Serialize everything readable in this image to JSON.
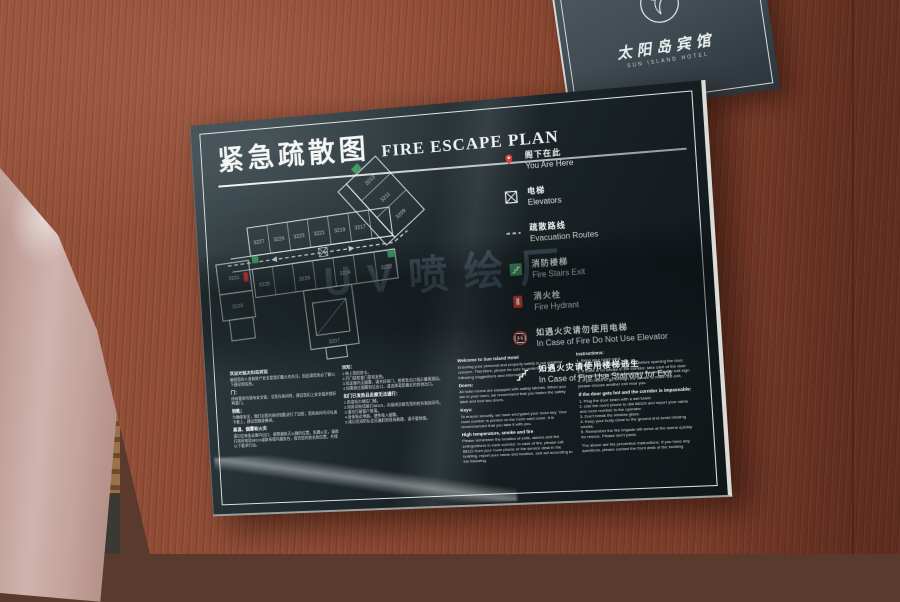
{
  "colors": {
    "accent_red": "#d93a35",
    "exit_green": "#3f9e63",
    "panel": "#1f292c",
    "wood": "#8a4a33",
    "watermark_blue": "#9ec1e4"
  },
  "header_sign": {
    "hotel_name_zh": "太阳岛宾馆",
    "hotel_name_en": "SUN ISLAND HOTEL"
  },
  "sign": {
    "title_zh": "紧急疏散图",
    "title_en": "FIRE ESCAPE PLAN",
    "watermark": "UV喷绘厂",
    "legend": {
      "items": [
        {
          "icon": "you-are-here-marker",
          "zh": "阁下在此",
          "en": "You Are Here"
        },
        {
          "icon": "elevator",
          "zh": "电梯",
          "en": "Elevators"
        },
        {
          "icon": "evacuation-route",
          "zh": "疏散路线",
          "en": "Evacuation Routes"
        },
        {
          "icon": "fire-stairs",
          "zh": "消防楼梯",
          "en": "Fire Stairs Exit"
        },
        {
          "icon": "fire-hydrant",
          "zh": "消火栓",
          "en": "Fire Hydrant"
        },
        {
          "icon": "no-elevator",
          "zh": "如遇火灾请勿使用电梯",
          "en": "In Case of Fire Do Not Use Elevator"
        },
        {
          "icon": "stairway-exit",
          "zh": "如遇火灾请使用楼梯逃生",
          "en": "In Case of Fire Use Stairway for Exit"
        }
      ]
    },
    "plan": {
      "rooms": [
        "3231",
        "3229",
        "3227",
        "3225",
        "3223",
        "3221",
        "3219",
        "3217",
        "3228",
        "3226",
        "3224",
        "3222",
        "3207",
        "3213",
        "3211",
        "3209"
      ]
    },
    "info": {
      "col1": [
        {
          "h": "欢迎光临太阳岛宾馆",
          "p": "确保您的人身和财产安全是我们最大的关注，因此请您务必了解以下建议和信息。"
        },
        {
          "h": "门：",
          "p": "所有客房均装有安全锁，当您在房间时，建议您扣上安全锁并锁好两道门。"
        },
        {
          "h": "钥匙：",
          "p": "为确保安全，我们对您的房间钥匙进行了加密，您的房间号印在房卡套上，建议您随身携带。"
        },
        {
          "h": "高温、烟雾和火灾",
          "p": "请记住每条走廊内出口、报警器和灭火器的位置。如遇火灾，请拨打房间电话88119或联系楼内服务台，报告您的姓名和位置，并按以下要求行动。"
        }
      ],
      "col2": [
        {
          "h": "须知：",
          "p": "1.带上您的房卡。\n2.开门前检查门是否发热。\n3.如走廊内无烟雾，请关好房门，按紧急出口指示撤离酒店。\n4.如需穿过烟雾到达出口，请选择离您最近的其他出口。"
        },
        {
          "h": "如门已发热且走廊无法通行：",
          "p": "1.用湿毛巾堵住门缝。\n2.用房间电话拨打88119，向接线员报告您的姓名和房间号。\n3.请勿打破窗户玻璃。\n4.身体贴近地面，避免吸入烟雾。\n5.请记住消防队会迅速赶到现场救援，请不要惊慌。"
        }
      ],
      "col3": [
        {
          "h": "Welcome to Sun Island Hotel",
          "p": "Ensuring your personal and property safety is our greatest concern. Therefore, please be sure to understand the following suggestions and information."
        },
        {
          "h": "Doors:",
          "p": "All hotel rooms are equipped with safety latches. When you are in your room, we recommend that you fasten the safety latch and lock two doors."
        },
        {
          "h": "Keys:",
          "p": "To ensure security, we have encrypted your room key. Your room number is printed on the room card cover. It is recommended that you take it with you."
        },
        {
          "h": "High temperature, smoke and fire",
          "p": "Please remember the location of exits, alarms and fire extinguishers in each corridor. In case of fire, please call 88119 from your room phone or the service desk in the building, report your name and location, and act according to the following."
        }
      ],
      "col4": [
        {
          "h": "Instructions:",
          "p": "1. Bring your room card.\n2. Check whether the door is hot before opening the door.\n3. If there is no smoke in the corridor, take care of the door and evacuate the hotel according to the emergency exit sign.\n4. If you need to go through the smoke to reach the exit, please choose another exit near you."
        },
        {
          "h": "If the door gets hot and the corridor is impassable:",
          "p": "1. Plug the door seam with a wet towel.\n2. Use the room phone to dial 88119 and report your name and room number to the operator.\n3. Don't break the window glass.\n4. Keep your body close to the ground and avoid inhaling smoke.\n5. Remember the fire brigade will arrive at the scene quickly for rescue. Please don't panic."
        },
        {
          "h": "",
          "p": "The above are fire prevention instructions. If you have any questions, please contact the front desk of the building."
        }
      ]
    }
  }
}
